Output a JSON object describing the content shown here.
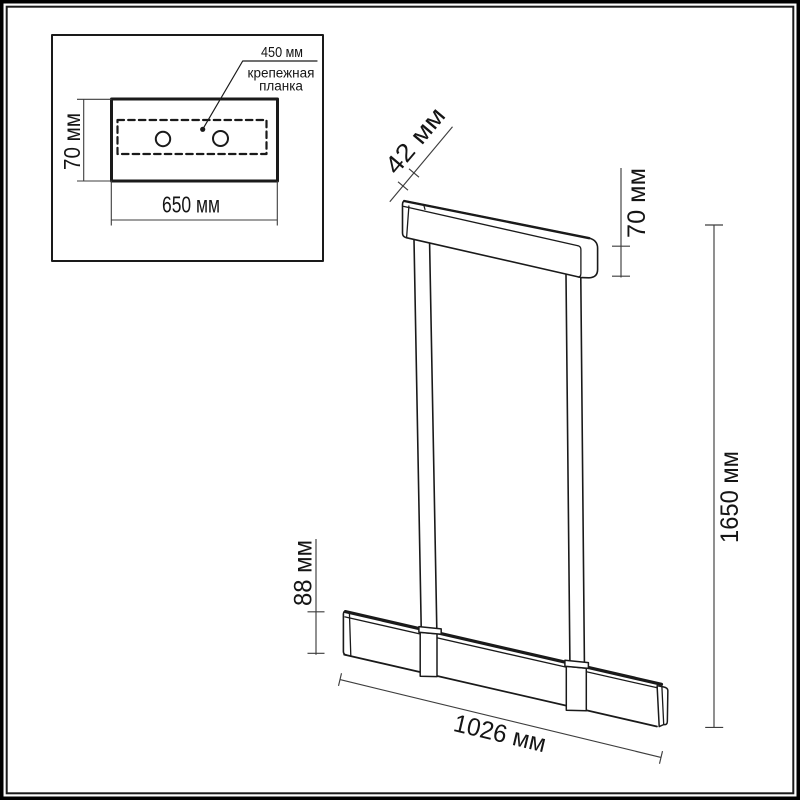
{
  "colors": {
    "outline": "#1a1a1a",
    "dimension": "#3d3d3d",
    "text": "#151515",
    "background": "#ffffff",
    "frame": "#000000"
  },
  "inset": {
    "hole_spacing_label": "450 мм",
    "plate_label_line1": "крепежная",
    "plate_label_line2": "планка",
    "plate_height_label": "70 мм",
    "plate_width_label": "650 мм"
  },
  "fixture": {
    "canopy_depth_label": "42 мм",
    "canopy_height_label": "70 мм",
    "overall_height_label": "1650 мм",
    "bar_height_label": "88 мм",
    "bar_length_label": "1026 мм"
  }
}
